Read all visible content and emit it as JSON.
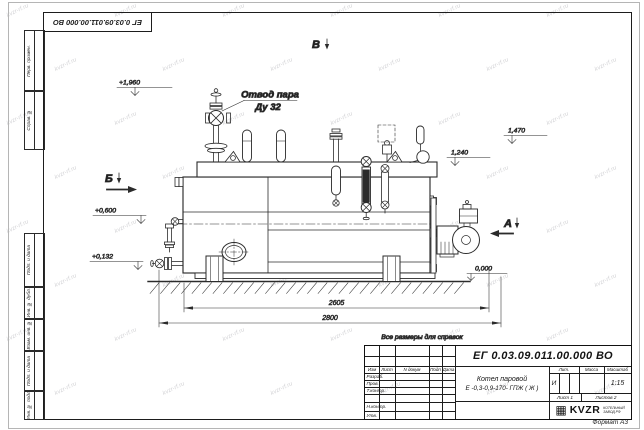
{
  "sheet": {
    "format_note": "Формат А3"
  },
  "margin_columns": {
    "perv_primen": "Перв. примен.",
    "sprav_no": "Справ. №",
    "podp_data_1": "Подп. и дата",
    "inv_dubl": "Инв. № дубл.",
    "vzam_inv": "Взам. инв. №",
    "podp_data_2": "Подп. и дата",
    "inv_podl": "Инв. № подл."
  },
  "watermark": {
    "text": "kvzr-rf.ru"
  },
  "drawing": {
    "note": "Все размеры для справок",
    "labels": {
      "steam_outlet_1": "Отвод пара",
      "steam_outlet_2": "Ду 32"
    },
    "views": {
      "v": "В",
      "b": "Б",
      "a": "А"
    },
    "elevations": {
      "top": "+1,960",
      "e1470": "1,470",
      "e1240": "1,240",
      "e0600": "+0,600",
      "e0132": "+0,132",
      "zero": "0,000"
    },
    "dimensions": {
      "inner": "2605",
      "outer": "2800"
    }
  },
  "title_block": {
    "doc_number": "ЕГ 0.03.09.011.00.000  ВО",
    "product_name_1": "Котел паровой",
    "product_name_2": "Е -0,3-0,9-170- ГПЖ ( Ж )",
    "headers": {
      "izm": "Изм",
      "list": "Лист",
      "n_dokum": "N докум",
      "podp": "Подп",
      "data": "Дата"
    },
    "rows": {
      "razrab": "Разраб.",
      "prov": "Пров.",
      "t_kontr": "Т.контр.",
      "n_kontr": "Н.контр.",
      "utv": "Утв."
    },
    "right": {
      "lit_header": "Лит.",
      "massa_header": "Масса",
      "masshtab_header": "Масштаб",
      "lit_value": "И",
      "scale": "1:15",
      "list_label": "Лист 1",
      "listov_label": "Листов 2"
    },
    "logo": {
      "mark_glyph": "▦",
      "brand": "KVZR",
      "tagline_1": "КОТЕЛЬНЫЙ",
      "tagline_2": "ЗАВОД РФ"
    }
  }
}
